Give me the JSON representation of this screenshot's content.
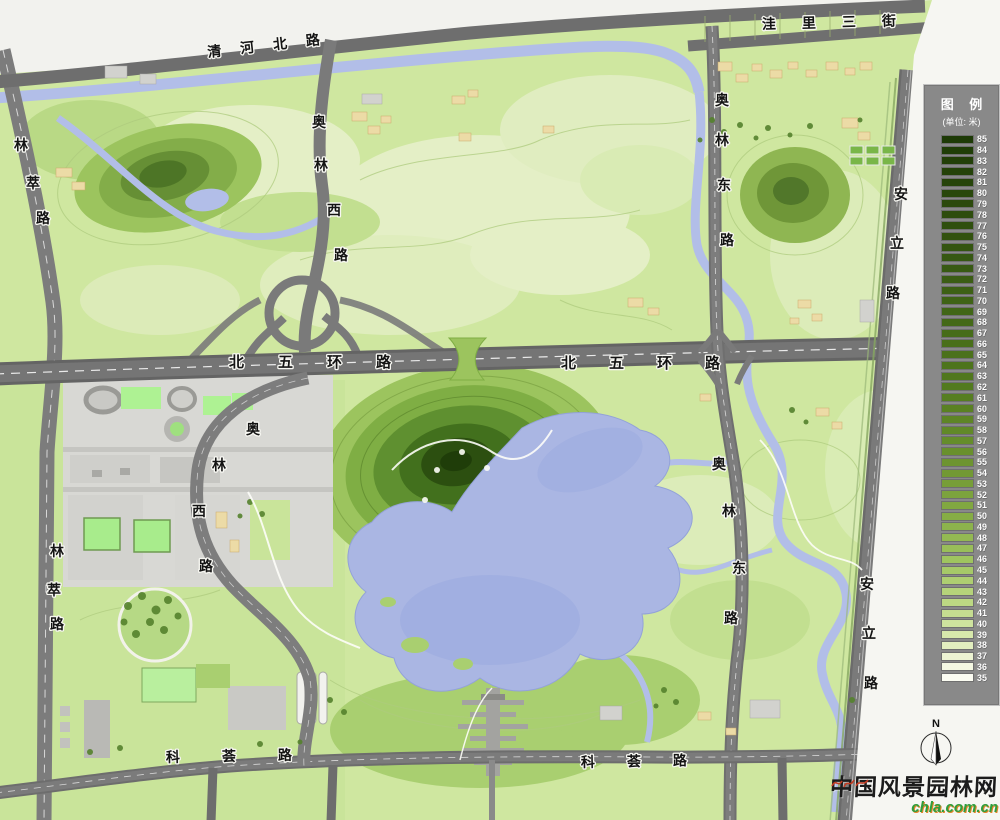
{
  "legend": {
    "title": "图 例",
    "unit": "(单位: 米)",
    "max": 85,
    "min": 35,
    "stops": [
      {
        "v": 85,
        "c": "#1d3a06"
      },
      {
        "v": 78,
        "c": "#2d4c0d"
      },
      {
        "v": 70,
        "c": "#3f6316"
      },
      {
        "v": 62,
        "c": "#527a1e"
      },
      {
        "v": 55,
        "c": "#6d9430"
      },
      {
        "v": 50,
        "c": "#86ad45"
      },
      {
        "v": 46,
        "c": "#9fc45f"
      },
      {
        "v": 42,
        "c": "#bcd883"
      },
      {
        "v": 39,
        "c": "#d7e8ab"
      },
      {
        "v": 37,
        "c": "#ecf3d2"
      },
      {
        "v": 35,
        "c": "#fbfcf2"
      }
    ]
  },
  "roads": {
    "qinghe_north": "清河北路",
    "wali_third": "洼里三街",
    "aolin_west": "奥林西路",
    "aolin_east": "奥林东路",
    "anli": "安立路",
    "lincui": "林萃路",
    "north_fifth_ring": "北五环路",
    "kehui": "科荟路"
  },
  "compass": {
    "north_label": "N"
  },
  "watermark": {
    "site_name": "中国风景园林网",
    "site_domain": "chla.com.cn"
  },
  "palette": {
    "park_green": "#cfe7a0",
    "field_light": "#e4efc6",
    "hill_dark": "#27470e",
    "water_blue": "#aab6e3",
    "road_gray": "#737373",
    "highway_gray": "#666666",
    "urban_gray": "#d8d8d4",
    "building_beige": "#ecdba6",
    "venue_green": "#aef293",
    "legend_bg": "#898989"
  }
}
